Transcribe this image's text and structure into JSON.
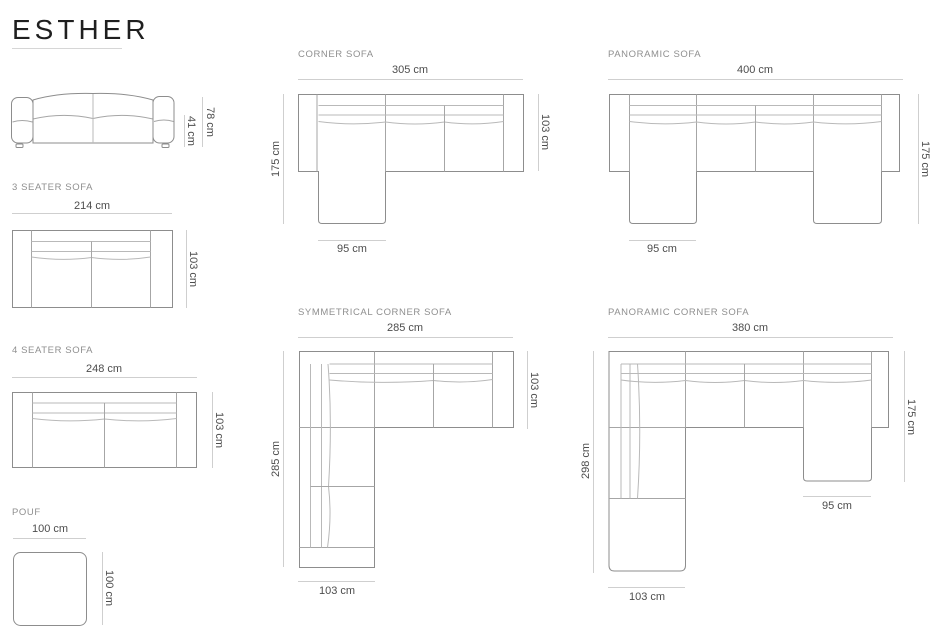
{
  "page": {
    "title": "ESTHER"
  },
  "palette": {
    "title_text": "#1f1f1f",
    "label_text": "#8f8f8f",
    "dim_text": "#4d4d4d",
    "outline": "#8d8d8d",
    "dim_line": "#cfcfcf"
  },
  "figures": {
    "front_view": {
      "dims": {
        "total_height": "78 cm",
        "seat_height": "41 cm"
      }
    },
    "three_seater": {
      "label": "3 SEATER SOFA",
      "dims": {
        "width": "214 cm",
        "depth": "103 cm"
      }
    },
    "four_seater": {
      "label": "4 SEATER SOFA",
      "dims": {
        "width": "248 cm",
        "depth": "103 cm"
      }
    },
    "pouf": {
      "label": "POUF",
      "dims": {
        "width": "100 cm",
        "depth": "100 cm"
      }
    },
    "corner": {
      "label": "CORNER SOFA",
      "dims": {
        "width": "305 cm",
        "chaise_depth": "175 cm",
        "depth": "103 cm",
        "chaise_width": "95 cm"
      }
    },
    "panoramic": {
      "label": "PANORAMIC SOFA",
      "dims": {
        "width": "400 cm",
        "chaise_depth": "175 cm",
        "chaise_width": "95 cm"
      }
    },
    "symmetrical_corner": {
      "label": "SYMMETRICAL CORNER SOFA",
      "dims": {
        "width": "285 cm",
        "depth": "103 cm",
        "left_length": "285 cm",
        "bottom_width": "103 cm"
      }
    },
    "panoramic_corner": {
      "label": "PANORAMIC CORNER SOFA",
      "dims": {
        "width": "380 cm",
        "chaise_depth": "175 cm",
        "left_length": "298 cm",
        "chaise_width": "95 cm",
        "bottom_width": "103 cm"
      }
    }
  }
}
